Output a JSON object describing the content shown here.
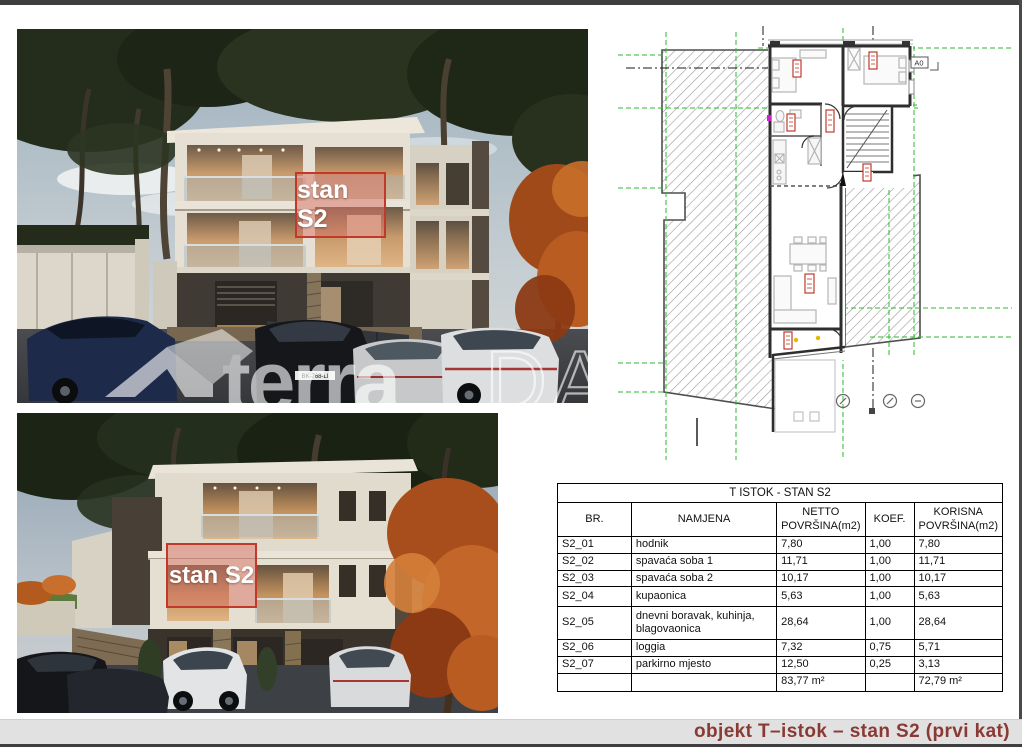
{
  "page": {
    "bottom_title": "objekt T–istok – stan S2 (prvi kat)"
  },
  "overlays": {
    "photo1_label": "stan S2",
    "photo2_label": "stan S2"
  },
  "watermark": {
    "brand": "terra",
    "brand_outline": "DALMAT"
  },
  "photo1": {
    "license_plate": "BK-768-LI"
  },
  "plan": {
    "marker_label": "A0"
  },
  "colors": {
    "accent_red": "#c0392b",
    "overlay_fill": "#d97769",
    "title_maroon": "#8a3a34",
    "plan_green": "#2eb82e",
    "bar_gray": "#e1e1e1"
  },
  "table": {
    "title": "T ISTOK - STAN S2",
    "headers": {
      "br": "BR.",
      "namjena": "NAMJENA",
      "netto": "NETTO POVRŠINA(m2)",
      "koef": "KOEF.",
      "korisna": "KORISNA POVRŠINA(m2)"
    },
    "rows": [
      {
        "br": "S2_01",
        "namjena": "hodnik",
        "netto": "7,80",
        "koef": "1,00",
        "korisna": "7,80"
      },
      {
        "br": "S2_02",
        "namjena": "spavaća soba 1",
        "netto": "11,71",
        "koef": "1,00",
        "korisna": "11,71"
      },
      {
        "br": "S2_03",
        "namjena": "spavaća soba 2",
        "netto": "10,17",
        "koef": "1,00",
        "korisna": "10,17"
      },
      {
        "br": "S2_04",
        "namjena": "kupaonica",
        "netto": "5,63",
        "koef": "1,00",
        "korisna": "5,63"
      },
      {
        "br": "S2_05",
        "namjena": "dnevni boravak, kuhinja, blagovaonica",
        "netto": "28,64",
        "koef": "1,00",
        "korisna": "28,64"
      },
      {
        "br": "S2_06",
        "namjena": "loggia",
        "netto": "7,32",
        "koef": "0,75",
        "korisna": "5,71"
      },
      {
        "br": "S2_07",
        "namjena": "parkirno mjesto",
        "netto": "12,50",
        "koef": "0,25",
        "korisna": "3,13"
      }
    ],
    "totals": {
      "netto": "83,77 m²",
      "korisna": "72,79 m²"
    }
  }
}
